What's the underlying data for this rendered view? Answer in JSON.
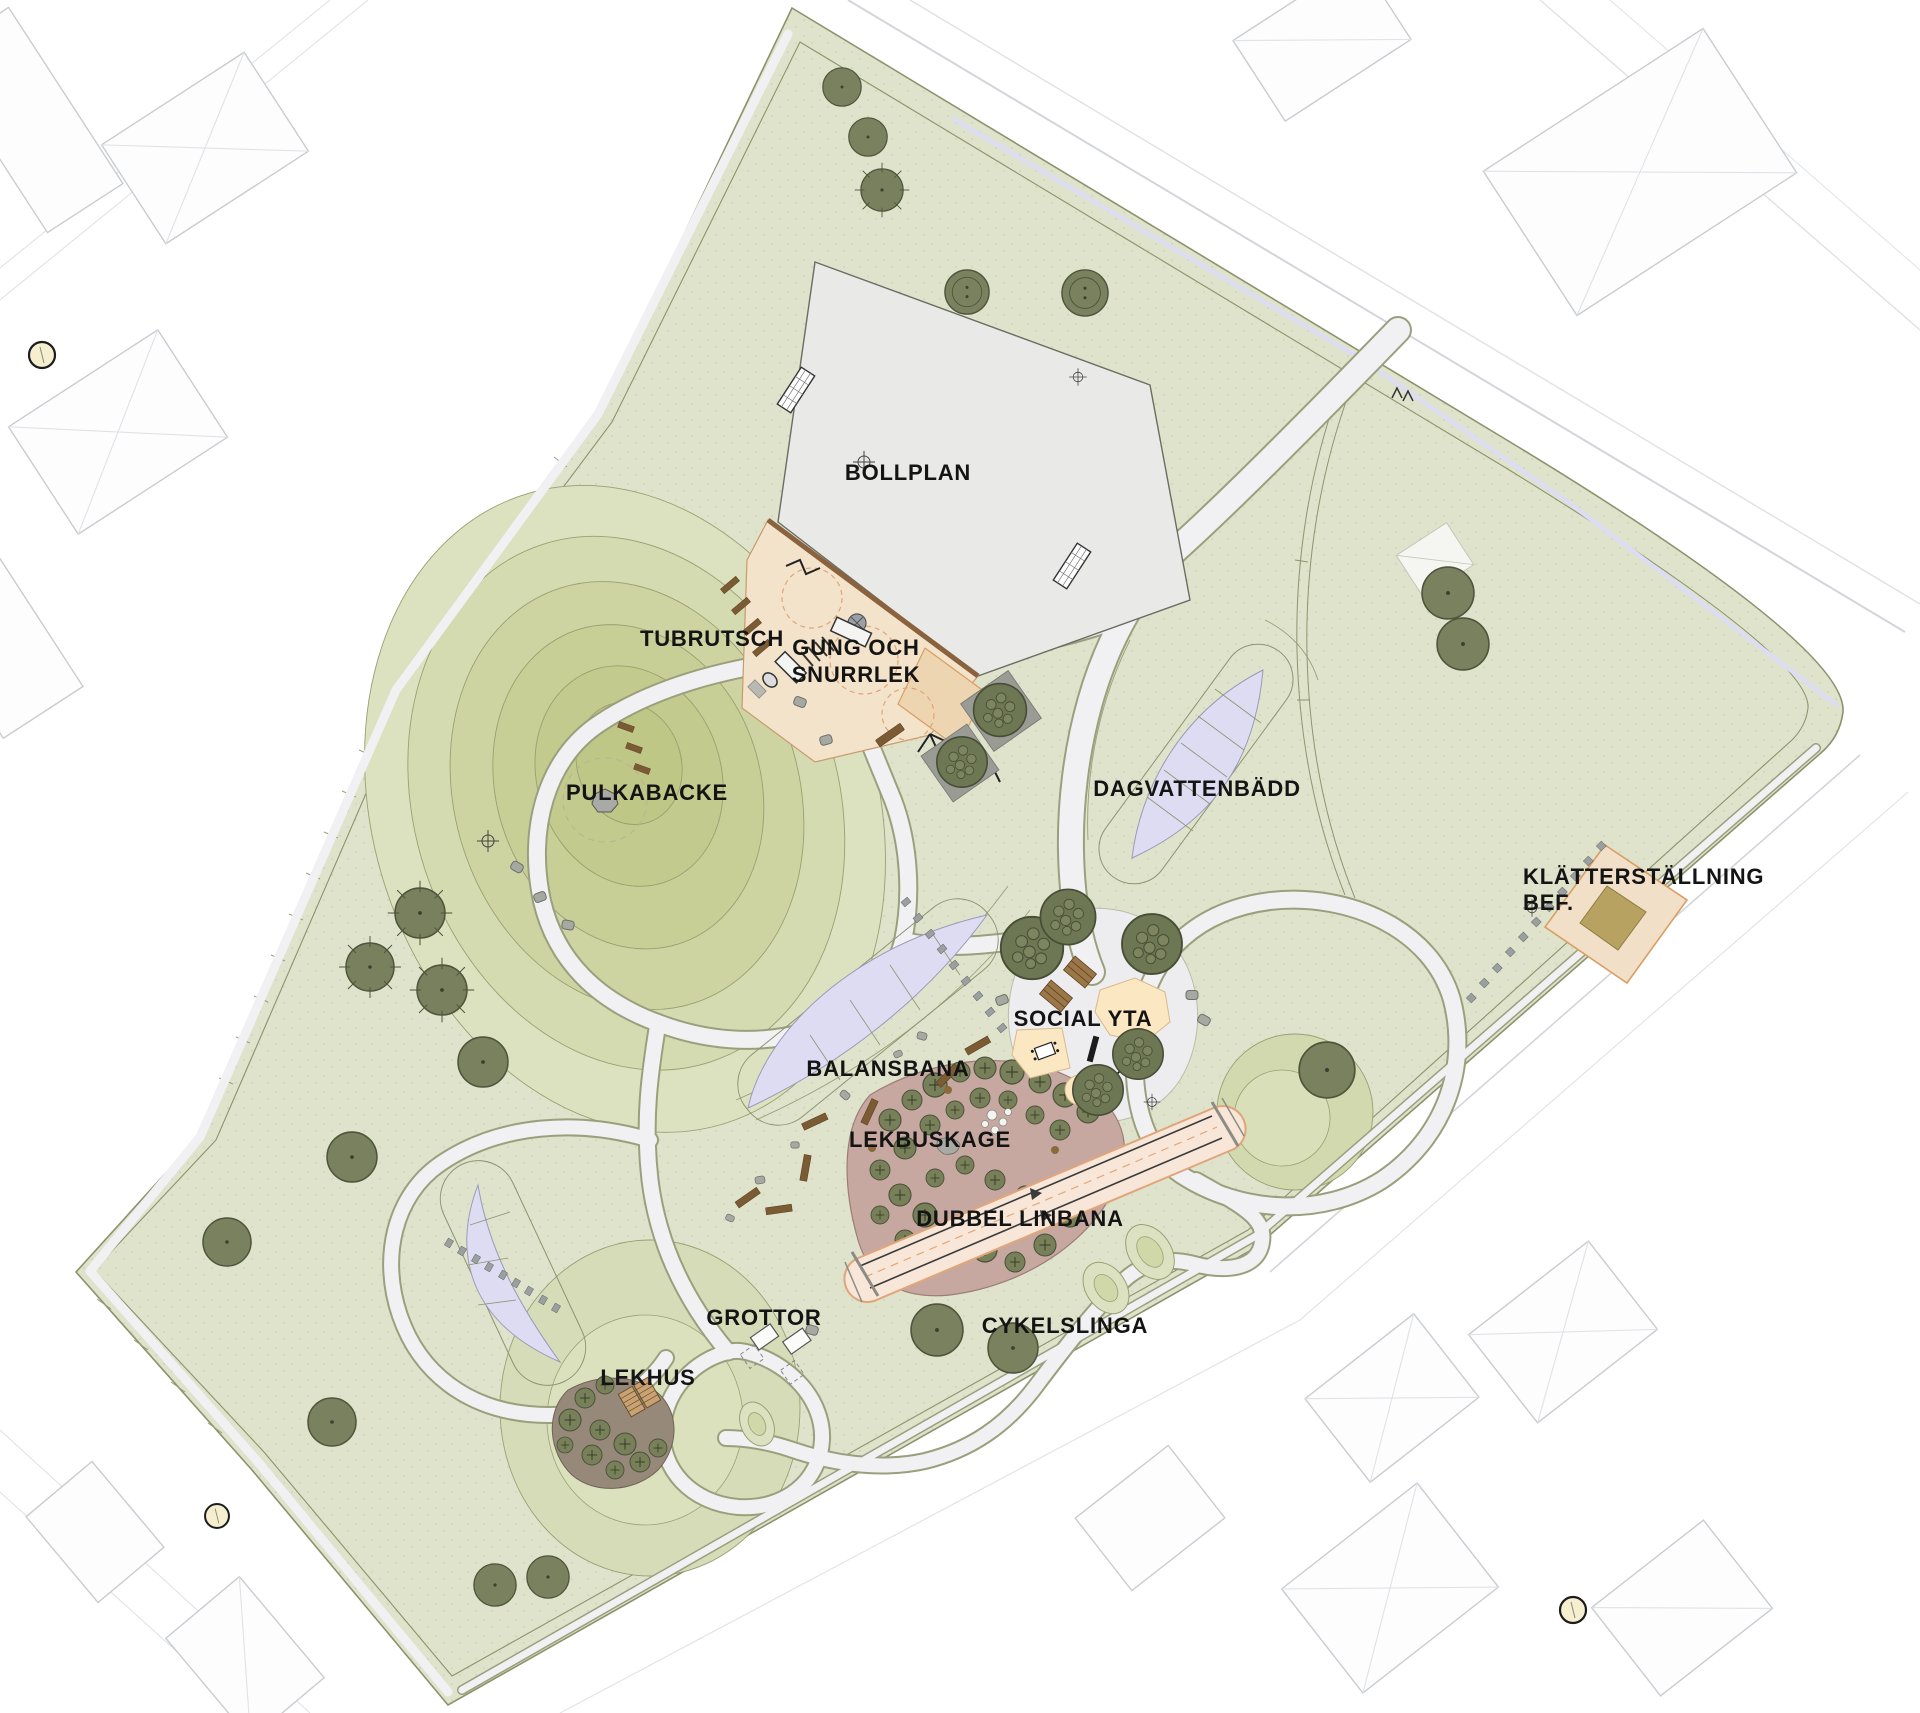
{
  "map": {
    "kind": "landscape-architecture-site-plan",
    "labels": {
      "bollplan": "BOLLPLAN",
      "tubrutsch": "TUBRUTSCH",
      "gung_line1": "GUNG OCH",
      "gung_line2": "SNURRLEK",
      "pulkabacke": "PULKABACKE",
      "dagvattenbadd": "DAGVATTENBÄDD",
      "klatterstallning_line1": "KLÄTTERSTÄLLNING",
      "klatterstallning_line2": "BEF.",
      "social_yta": "SOCIAL YTA",
      "balansbana": "BALANSBANA",
      "lekbuskage": "LEKBUSKAGE",
      "dubbel_linbana": "DUBBEL LINBANA",
      "grottor": "GROTTOR",
      "cykelslinga": "CYKELSLINGA",
      "lekhus": "LEKHUS"
    },
    "palette": {
      "background": "#ffffff",
      "park_green": "#dfe3cc",
      "hill_olive_dark": "#bfc787",
      "path_fill": "#f1f1f4",
      "path_casing": "#9aa07c",
      "field_gray": "#e9e9e7",
      "sand_beige": "#f4e3cb",
      "sand_edge_brown": "#8a623d",
      "shrubbery_mauve": "#c7a8a1",
      "pond_lavender": "#dedcf2",
      "zipline_pink": "#f8e7d8",
      "accent_orange": "#d99e63",
      "wood_brown": "#7b5b33",
      "tree_olive": "#7a815f",
      "cream_patch": "#fbe7c2",
      "marker_yellow": "#f5efcf",
      "label_color": "#141414"
    }
  }
}
